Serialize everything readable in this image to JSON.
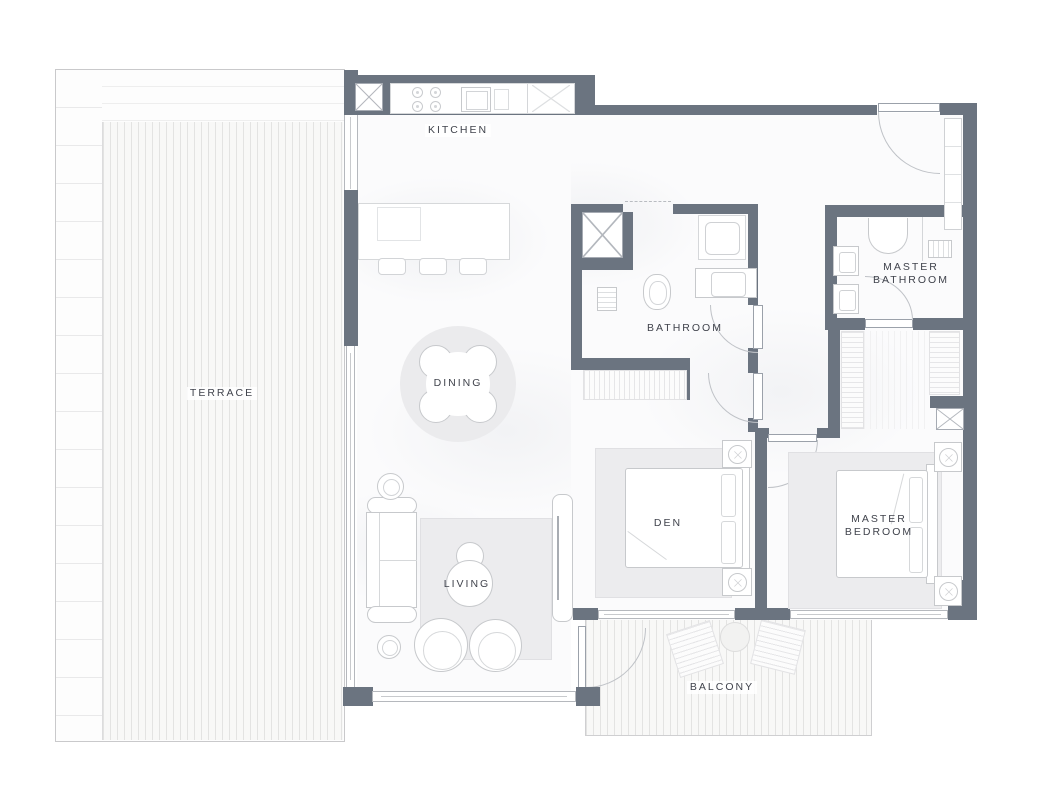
{
  "plan": {
    "type": "apartment-floor-plan",
    "rooms": [
      {
        "id": "kitchen",
        "label": "KITCHEN"
      },
      {
        "id": "terrace",
        "label": "TERRACE"
      },
      {
        "id": "dining",
        "label": "DINING"
      },
      {
        "id": "bathroom",
        "label": "BATHROOM"
      },
      {
        "id": "master-bathroom",
        "label": "MASTER BATHROOM",
        "lines": [
          "MASTER",
          "BATHROOM"
        ]
      },
      {
        "id": "den",
        "label": "DEN"
      },
      {
        "id": "master-bedroom",
        "label": "MASTER BEDROOM",
        "lines": [
          "MASTER",
          "BEDROOM"
        ]
      },
      {
        "id": "living",
        "label": "LIVING"
      },
      {
        "id": "balcony",
        "label": "BALCONY"
      }
    ],
    "colors": {
      "wall": "#6b7480",
      "label_text": "#40434c",
      "rug": "#ececee",
      "furniture_stroke": "#c7c9cc",
      "deck_line": "#e3e3e2",
      "floor": "#fbfbfc"
    }
  }
}
